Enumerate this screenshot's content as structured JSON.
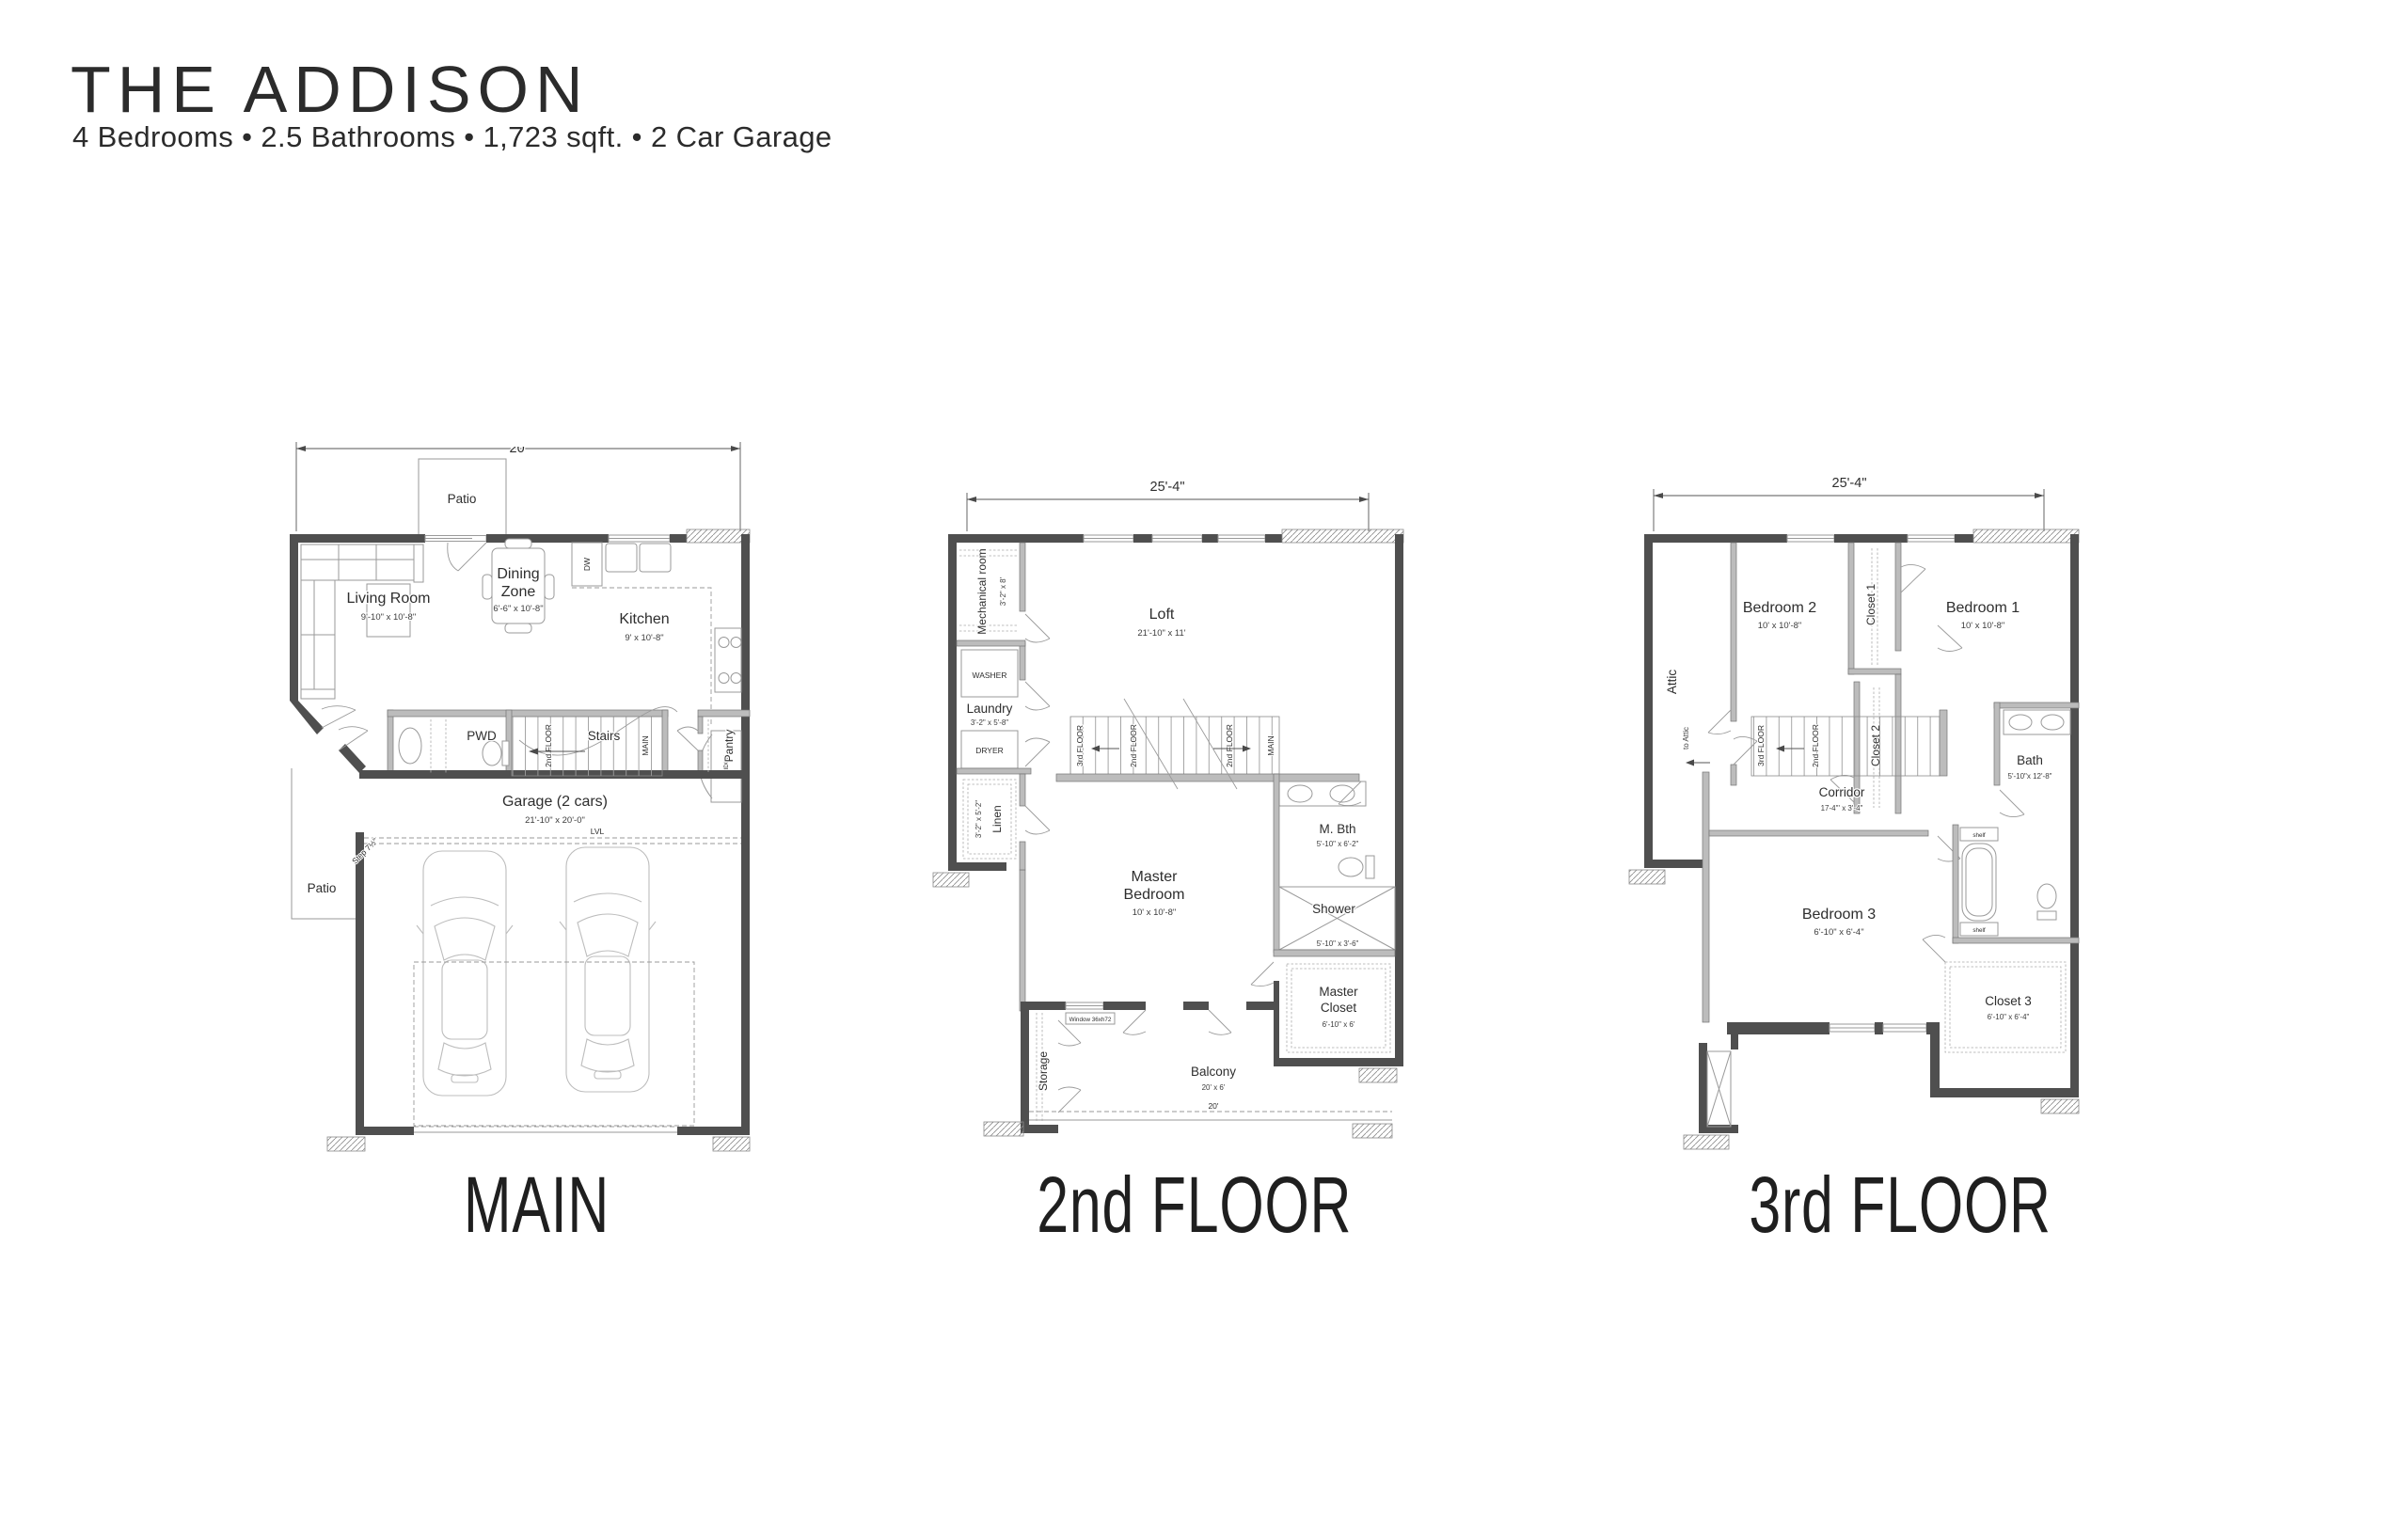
{
  "header": {
    "title": "THE ADDISON",
    "subtitle": "4 Bedrooms • 2.5 Bathrooms • 1,723 sqft. • 2 Car Garage"
  },
  "plans": {
    "main": {
      "title": "MAIN",
      "dim_top": "20'",
      "patio_top": "Patio",
      "living": "Living Room",
      "living_dims": "9'-10\" x 10'-8\"",
      "dining1": "Dining",
      "dining2": "Zone",
      "dining_dims": "6'-6\" x 10'-8\"",
      "kitchen": "Kitchen",
      "kitchen_dims": "9' x 10'-8\"",
      "dw": "DW",
      "fridge": "FRIDGE",
      "pantry": "Pantry",
      "pwd": "PWD",
      "stairs": "Stairs",
      "stair_up": "2nd FLOOR",
      "stair_here": "MAIN",
      "garage": "Garage (2 cars)",
      "garage_dims": "21'-10\" x 20'-0\"",
      "lvl": "LVL",
      "step": "Step 7½\"",
      "patio_side": "Patio"
    },
    "second": {
      "title": "2nd FLOOR",
      "dim_top": "25'-4\"",
      "mech": "Mechanical room",
      "mech_dims": "3'-2\" x 8'",
      "loft": "Loft",
      "loft_dims": "21'-10\" x 11'",
      "washer": "WASHER",
      "laundry": "Laundry",
      "laundry_dims": "3'-2\" x 5'-8\"",
      "dryer": "DRYER",
      "linen": "Linen",
      "linen_dims": "3'-2\" x 5'-2\"",
      "stair_3rd": "3rd FLOOR",
      "stair_2nd_a": "2nd FLOOR",
      "stair_2nd_b": "2nd FLOOR",
      "stair_main": "MAIN",
      "master1": "Master",
      "master2": "Bedroom",
      "master_dims": "10' x 10'-8\"",
      "mbth": "M. Bth",
      "mbth_dims": "5'-10\" x 6'-2\"",
      "shower": "Shower",
      "shower_dims": "5'-10\" x 3'-6\"",
      "mcloset1": "Master",
      "mcloset2": "Closet",
      "mcloset_dims": "6'-10\" x 6'",
      "storage": "Storage",
      "window_label": "Window 36xh72",
      "balcony": "Balcony",
      "balcony_dims": "20' x 6'",
      "balcony_width": "20'"
    },
    "third": {
      "title": "3rd FLOOR",
      "dim_top": "25'-4\"",
      "bedroom2": "Bedroom 2",
      "bedroom2_dims": "10' x 10'-8\"",
      "bedroom1": "Bedroom 1",
      "bedroom1_dims": "10' x 10'-8\"",
      "closet1": "Closet 1",
      "closet2": "Closet 2",
      "attic": "Attic",
      "to_attic": "to Attic",
      "stair_3rd": "3rd FLOOR",
      "stair_2nd": "2nd FLOOR",
      "corridor": "Corridor",
      "corridor_dims": "17-4\"' x 3'-4\"",
      "bath": "Bath",
      "bath_dims": "5'-10\"x 12'-8\"",
      "shelf_a": "shelf",
      "shelf_b": "shelf",
      "bedroom3": "Bedroom 3",
      "bedroom3_dims": "6'-10\" x 6'-4\"",
      "closet3": "Closet 3",
      "closet3_dims": "6'-10\" x 6'-4\""
    }
  }
}
